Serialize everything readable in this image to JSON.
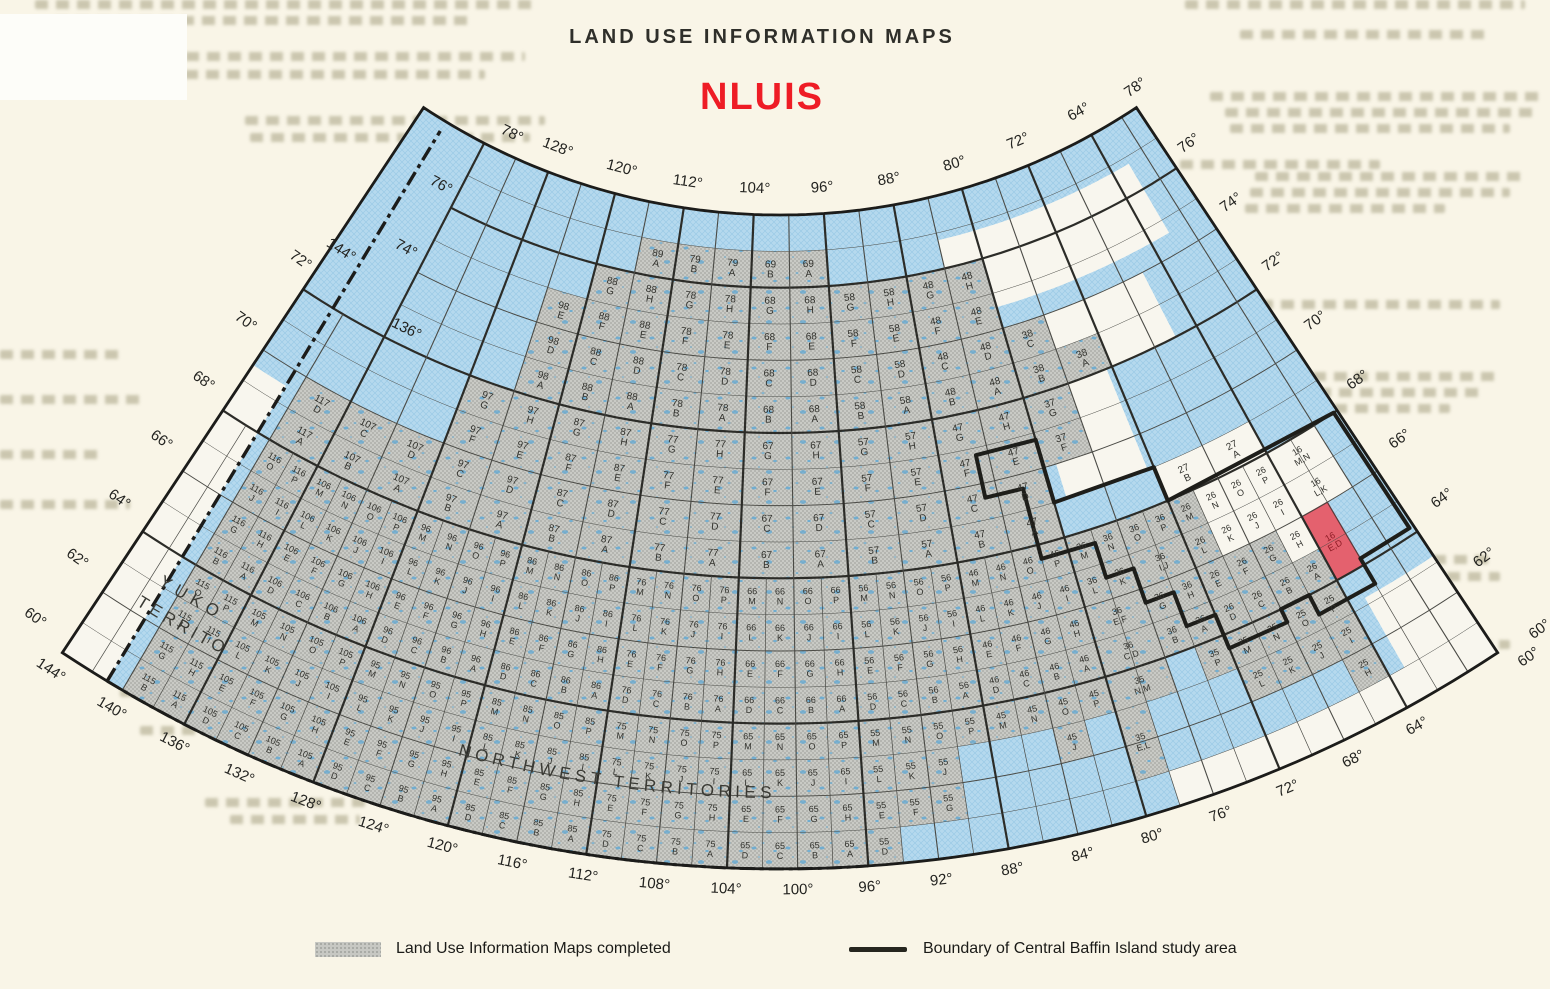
{
  "title": "LAND USE INFORMATION MAPS",
  "subtitle": "NLUIS",
  "legend": {
    "completed": "Land Use Information Maps completed",
    "boundary": "Boundary of Central Baffin Island study area"
  },
  "territories": {
    "yukon_line1": "YUKON",
    "yukon_line2": "TERRITORY",
    "nwt": "NORTHWEST TERRITORIES"
  },
  "colors": {
    "water": "#b5d9ee",
    "water_hatch": "#9ccae6",
    "land": "#f8f6ee",
    "completed_gray": "#c9cac5",
    "completed_dot": "#a2a49f",
    "lake": "#58a7d6",
    "red_cell": "#e4616e",
    "red_cell_text": "#8c1b24",
    "accent_red": "#ee1c25",
    "grid": "#4a4a45",
    "grid_heavy": "#2c2c28",
    "neatline": "#1c1c1a",
    "boundary": "#1e1e1a",
    "label": "#32322d",
    "edge_label": "#232320"
  },
  "graticule": {
    "deg": "°",
    "top_lons": [
      128,
      120,
      112,
      104,
      96,
      88,
      80,
      72,
      64
    ],
    "bottom_lons": [
      144,
      140,
      136,
      132,
      128,
      124,
      120,
      116,
      112,
      108,
      104,
      100,
      96,
      92,
      88,
      84,
      80,
      76,
      72,
      68,
      64
    ],
    "left_lats": [
      70,
      68,
      66,
      64,
      62,
      60
    ],
    "upper_left_lats": [
      76,
      74
    ],
    "right_lats": [
      76,
      74,
      72,
      70,
      68,
      66,
      64,
      62
    ],
    "corner_labels": [
      {
        "text": "78",
        "lon": 133.6,
        "lat": 78.45
      },
      {
        "text": "78",
        "lon": 56.8,
        "lat": 78.35
      },
      {
        "text": "72",
        "lon": 145.6,
        "lat": 72.5
      },
      {
        "text": "144",
        "lon": 143.1,
        "lat": 73.35
      },
      {
        "text": "136",
        "lon": 134.6,
        "lat": 72.35
      },
      {
        "text": "60",
        "lon": 56.7,
        "lat": 59.3
      },
      {
        "text": "60",
        "lon": 55.3,
        "lat": 59.75
      }
    ]
  },
  "highlight": {
    "block": "16",
    "letters": "E,D"
  },
  "blocks": [
    {
      "n": "115",
      "w": 144,
      "s": 60,
      "c": 4,
      "g": [
        "O",
        "P",
        "J",
        "I",
        "G",
        "H",
        "B",
        "A"
      ]
    },
    {
      "n": "105",
      "w": 136,
      "s": 60,
      "c": 4,
      "g": "all"
    },
    {
      "n": "95",
      "w": 128,
      "s": 60,
      "c": 4,
      "g": "all"
    },
    {
      "n": "85",
      "w": 120,
      "s": 60,
      "c": 4,
      "g": "all"
    },
    {
      "n": "75",
      "w": 112,
      "s": 60,
      "c": 4,
      "g": "all"
    },
    {
      "n": "65",
      "w": 104,
      "s": 60,
      "c": 4,
      "g": "all"
    },
    {
      "n": "55",
      "w": 96,
      "s": 60,
      "c": 4,
      "g": [
        "M",
        "N",
        "O",
        "P",
        "L",
        "K",
        "J",
        "G",
        "F",
        "E",
        "D"
      ]
    },
    {
      "n": "45",
      "w": 88,
      "s": 60,
      "c": 4,
      "g": [
        "M",
        "N",
        "O",
        "P",
        "J"
      ]
    },
    {
      "n": "35",
      "w": 80,
      "s": 60,
      "c": 4,
      "g": [
        "P",
        "N,M",
        "E,L"
      ]
    },
    {
      "n": "25",
      "w": 72,
      "s": 60,
      "c": 4,
      "g": [
        "M",
        "N",
        "O",
        "P",
        "L",
        "K",
        "J",
        "I",
        "H"
      ]
    },
    {
      "n": "116",
      "w": 144,
      "s": 64,
      "c": 4,
      "g": [
        "O",
        "P",
        "J",
        "I",
        "G",
        "H",
        "B",
        "A"
      ]
    },
    {
      "n": "106",
      "w": 136,
      "s": 64,
      "c": 4,
      "g": "all"
    },
    {
      "n": "96",
      "w": 128,
      "s": 64,
      "c": 4,
      "g": "all"
    },
    {
      "n": "86",
      "w": 120,
      "s": 64,
      "c": 4,
      "g": "all"
    },
    {
      "n": "76",
      "w": 112,
      "s": 64,
      "c": 4,
      "g": "all"
    },
    {
      "n": "66",
      "w": 104,
      "s": 64,
      "c": 4,
      "g": "all"
    },
    {
      "n": "56",
      "w": 96,
      "s": 64,
      "c": 4,
      "g": "all"
    },
    {
      "n": "46",
      "w": 88,
      "s": 64,
      "c": 4,
      "g": "all"
    },
    {
      "n": "36",
      "w": 80,
      "s": 64,
      "c": 4,
      "g": [
        "M",
        "N",
        "O",
        "P",
        "L",
        "K",
        "I,J",
        "H",
        "G",
        "E,F",
        "C,D",
        "B",
        "A"
      ]
    },
    {
      "n": "26",
      "w": 72,
      "s": 64,
      "c": 4,
      "g": [
        "M",
        "L",
        "G",
        "F",
        "E",
        "D",
        "C",
        "B",
        "A"
      ],
      "wh": [
        "P",
        "O",
        "N",
        "K",
        "J",
        "I",
        "H"
      ]
    },
    {
      "n": "16",
      "w": 64,
      "s": 64,
      "c": 4,
      "wh": [
        "M,N",
        "L,K"
      ],
      "r": [
        "E,D"
      ]
    },
    {
      "n": "117",
      "w": 144,
      "s": 68,
      "c": 2,
      "g": [
        "A",
        "D"
      ]
    },
    {
      "n": "107",
      "w": 136,
      "s": 68,
      "c": 2,
      "g": [
        "B",
        "A",
        "C",
        "D"
      ]
    },
    {
      "n": "97",
      "w": 128,
      "s": 68,
      "c": 2,
      "g": "all"
    },
    {
      "n": "87",
      "w": 120,
      "s": 68,
      "c": 2,
      "g": "all"
    },
    {
      "n": "77",
      "w": 112,
      "s": 68,
      "c": 2,
      "g": "all"
    },
    {
      "n": "67",
      "w": 104,
      "s": 68,
      "c": 2,
      "g": "all"
    },
    {
      "n": "57",
      "w": 96,
      "s": 68,
      "c": 2,
      "g": "all"
    },
    {
      "n": "47",
      "w": 88,
      "s": 68,
      "c": 2,
      "g": "all"
    },
    {
      "n": "37",
      "w": 80,
      "s": 68,
      "c": 2,
      "g": [
        "F",
        "G"
      ]
    },
    {
      "n": "27",
      "w": 72,
      "s": 68,
      "c": 2,
      "wh": [
        "B",
        "A"
      ]
    },
    {
      "n": "98",
      "w": 128,
      "s": 72,
      "c": 2,
      "g": [
        "A",
        "D",
        "E"
      ]
    },
    {
      "n": "88",
      "w": 120,
      "s": 72,
      "c": 2,
      "g": "all"
    },
    {
      "n": "78",
      "w": 112,
      "s": 72,
      "c": 2,
      "g": "all"
    },
    {
      "n": "68",
      "w": 104,
      "s": 72,
      "c": 2,
      "g": "all"
    },
    {
      "n": "58",
      "w": 96,
      "s": 72,
      "c": 2,
      "g": "all"
    },
    {
      "n": "48",
      "w": 88,
      "s": 72,
      "c": 2,
      "g": "all"
    },
    {
      "n": "38",
      "w": 80,
      "s": 72,
      "c": 2,
      "g": [
        "B",
        "A",
        "C"
      ]
    },
    {
      "n": "89",
      "w": 120,
      "s": 76,
      "c": 2,
      "g": [
        "A"
      ]
    },
    {
      "n": "79",
      "w": 112,
      "s": 76,
      "c": 2,
      "g": [
        "B",
        "A"
      ]
    },
    {
      "n": "69",
      "w": 104,
      "s": 76,
      "c": 2,
      "g": [
        "B",
        "A"
      ]
    }
  ],
  "study_boundary": [
    [
      85,
      70.8
    ],
    [
      80,
      70.8
    ],
    [
      80,
      69
    ],
    [
      72,
      69
    ],
    [
      72,
      68
    ],
    [
      58.3,
      68
    ],
    [
      58.3,
      64.2
    ],
    [
      62,
      64.2
    ],
    [
      62,
      63.4
    ],
    [
      66,
      63.4
    ],
    [
      66,
      64
    ],
    [
      68,
      64
    ],
    [
      68,
      63.6
    ],
    [
      72,
      63.6
    ],
    [
      72,
      64.6
    ],
    [
      74,
      64.6
    ],
    [
      74,
      65.6
    ],
    [
      76,
      65.6
    ],
    [
      76,
      66.6
    ],
    [
      78,
      66.6
    ],
    [
      78,
      67.6
    ],
    [
      82,
      67.6
    ],
    [
      82,
      69.6
    ],
    [
      85,
      69.6
    ]
  ],
  "white_patches": [
    [
      144,
      141,
      60,
      69.5
    ],
    [
      78,
      58,
      60,
      61
    ],
    [
      63,
      58,
      61,
      63.2
    ],
    [
      79,
      72.5,
      69,
      73.3
    ],
    [
      76,
      66,
      72,
      74.0
    ],
    [
      84,
      62,
      74.6,
      76.8
    ]
  ]
}
